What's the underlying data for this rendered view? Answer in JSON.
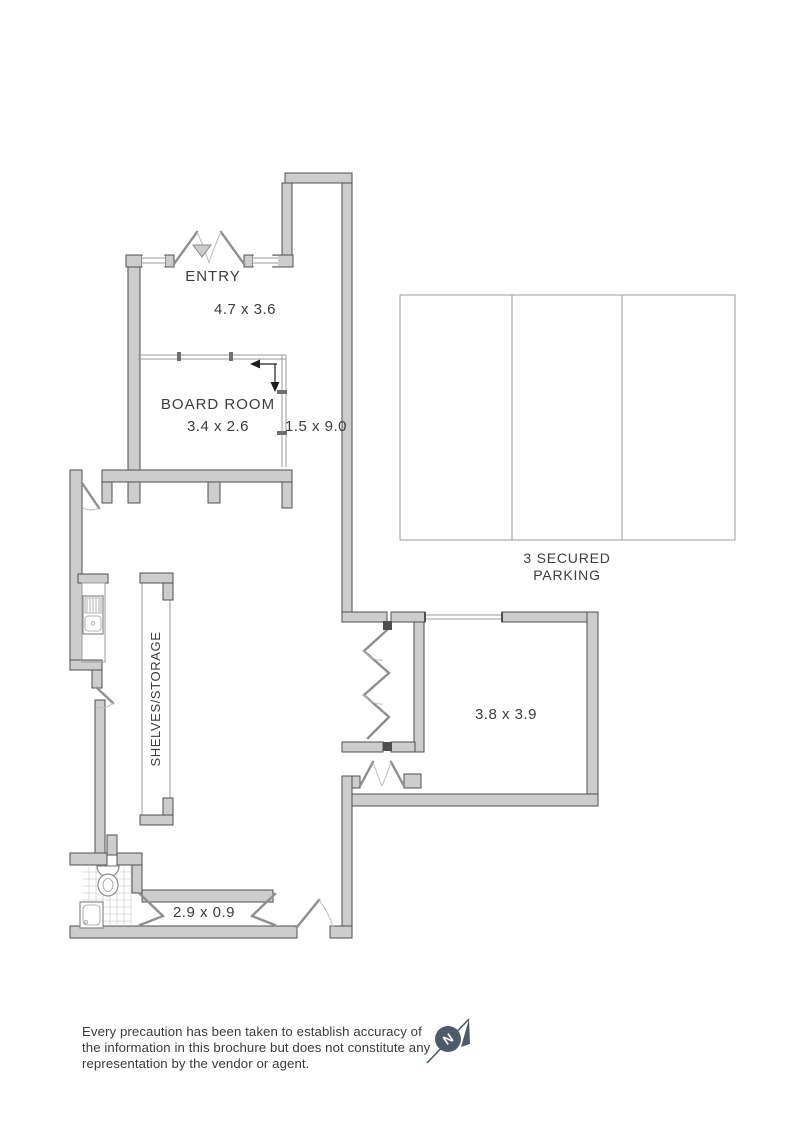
{
  "plan": {
    "entry": {
      "label": "ENTRY",
      "dims": "4.7 x 3.6"
    },
    "board_room": {
      "label": "BOARD ROOM",
      "dims": "3.4 x 2.6"
    },
    "hallway": {
      "dims": "1.5 x 9.0"
    },
    "parking": {
      "line1": "3 SECURED",
      "line2": "PARKING"
    },
    "storage": {
      "label": "SHELVES/STORAGE"
    },
    "store_room": {
      "dims": "3.8 x 3.9"
    },
    "passage": {
      "dims": "2.9 x 0.9"
    },
    "compass": {
      "north_label": "N"
    }
  },
  "disclaimer": {
    "line1": "Every precaution has been taken to establish accuracy of",
    "line2": "the information in this brochure but does not constitute any",
    "line3": "representation by the vendor or agent."
  },
  "colors": {
    "wall_fill": "#cdcdcd",
    "wall_stroke": "#4f4f4f",
    "partition_line": "#9b9b9b",
    "label_text": "#3c3c3c",
    "compass": "#4e5a68",
    "background": "#ffffff"
  }
}
